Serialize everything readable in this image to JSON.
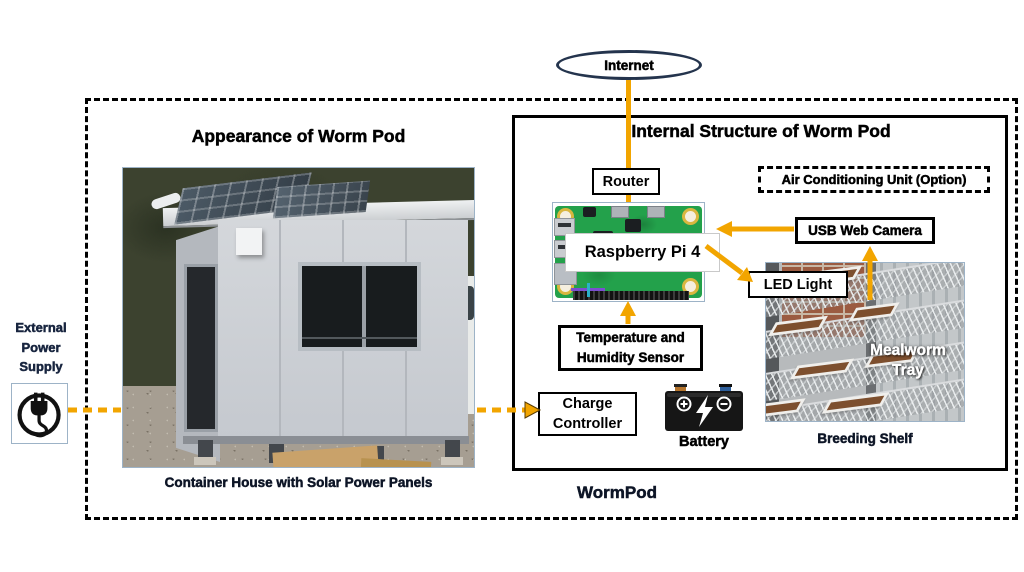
{
  "labels": {
    "internet": "Internet",
    "appearance_title": "Appearance of Worm Pod",
    "internal_title": "Internal Structure of Worm Pod",
    "router": "Router",
    "ac_unit": "Air Conditioning Unit (Option)",
    "raspberry_pi": "Raspberry Pi 4",
    "usb_camera": "USB Web Camera",
    "led_light": "LED Light",
    "sensor_line1": "Temperature and",
    "sensor_line2": "Humidity Sensor",
    "charge_line1": "Charge",
    "charge_line2": "Controller",
    "battery": "Battery",
    "mealworm_line1": "Mealworm",
    "mealworm_line2": "Tray",
    "breeding_shelf": "Breeding Shelf",
    "container_caption": "Container House with Solar Power Panels",
    "wormpod": "WormPod",
    "external_power_line1": "External",
    "external_power_line2": "Power",
    "external_power_line3": "Supply"
  },
  "icons": {
    "power_plug": "power-plug-icon",
    "battery": "battery-icon",
    "lightning_bolt": "lightning-bolt-icon"
  },
  "colors": {
    "connector_gold": "#F2A500",
    "ellipse_border": "#24344D",
    "caption_ink": "#0D1526"
  }
}
